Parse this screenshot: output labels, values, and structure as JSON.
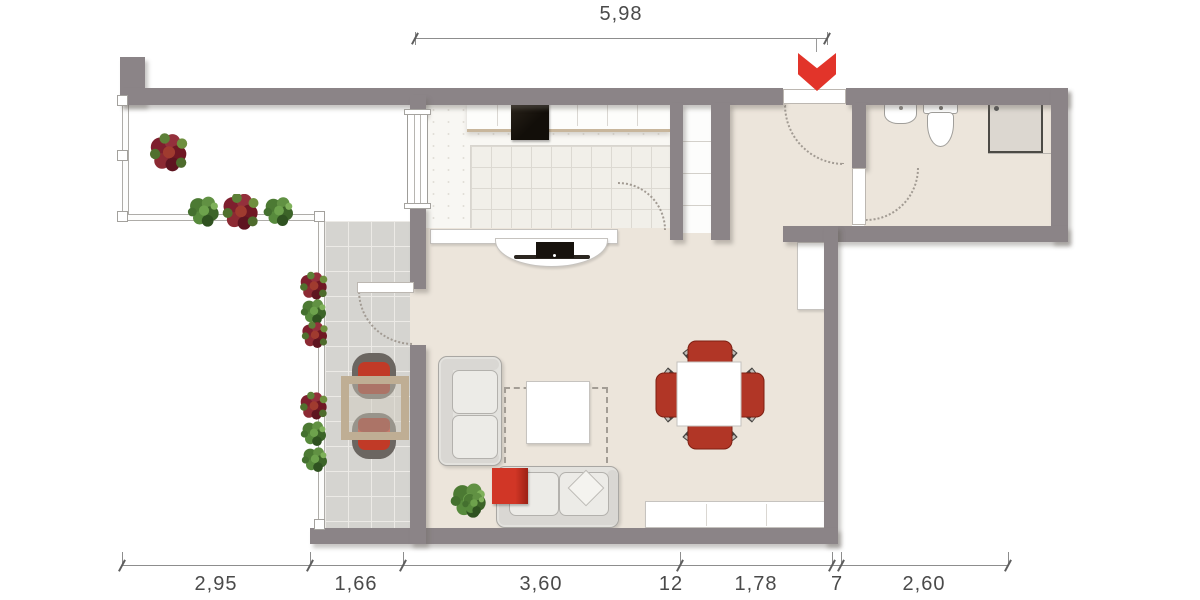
{
  "dimensions": {
    "top": [
      "5,98"
    ],
    "bottom": [
      "2,95",
      "1,66",
      "3,60",
      "12",
      "1,78",
      "7",
      "2,60"
    ]
  },
  "entrance": {
    "marker": "chevron-down",
    "color": "#e2342a"
  },
  "palette": {
    "wall": "#8b8487",
    "interior_floor": "#ece5db",
    "terrace_tile": "#d5d4d0",
    "kitchen_tile": "#f1efe9",
    "accent_red": "#cc3226",
    "dining_chair_red": "#b13626",
    "terrace_table_tan": "#bfae94",
    "dimension_text": "#4a4a4a"
  }
}
